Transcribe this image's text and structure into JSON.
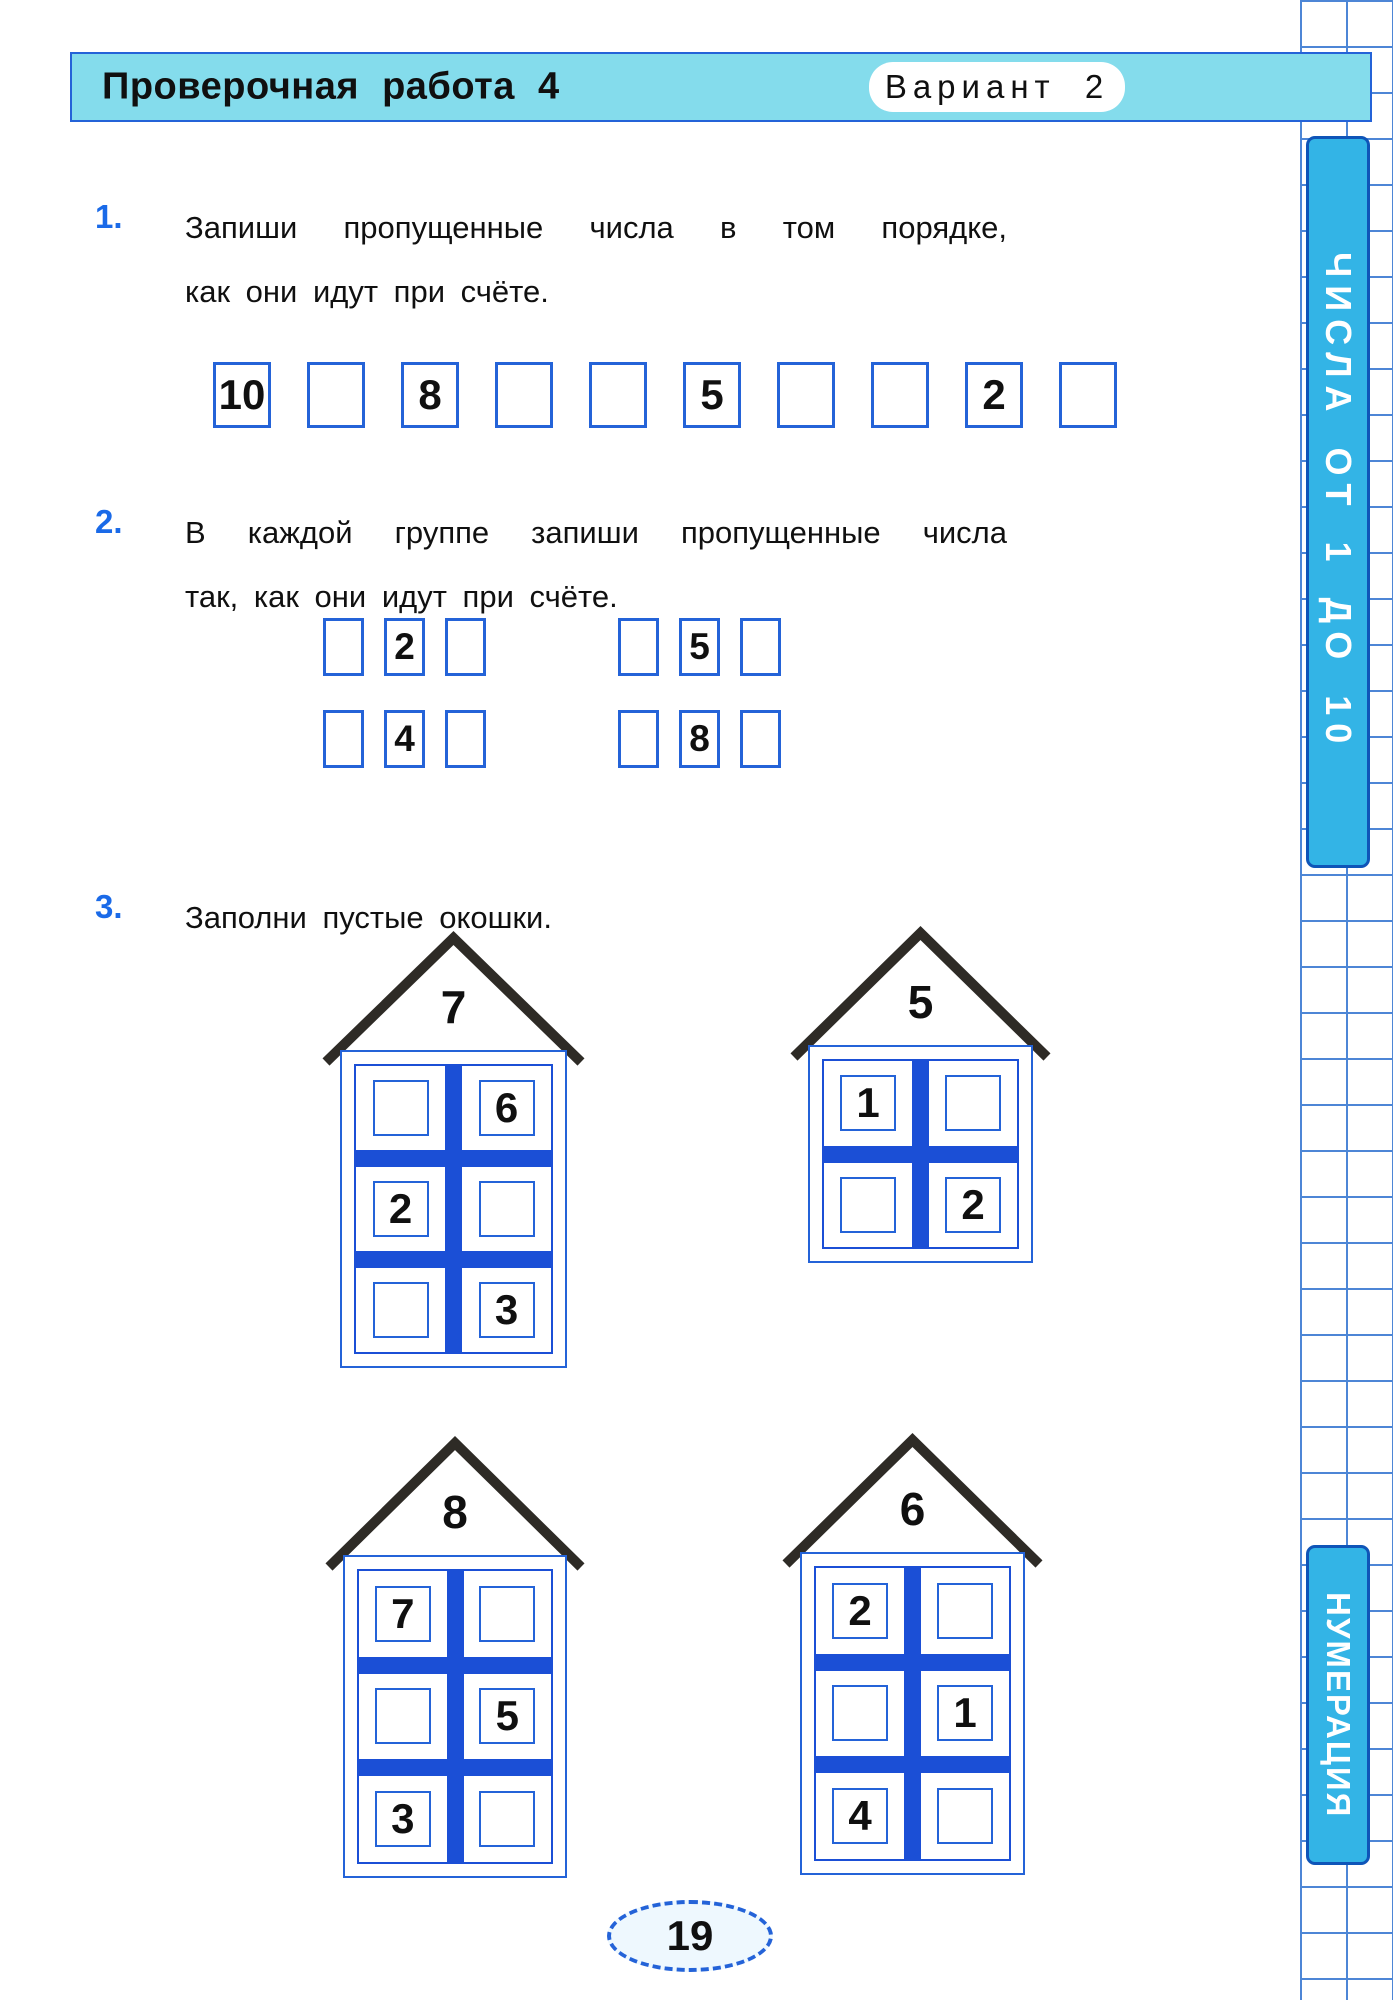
{
  "header": {
    "title": "Проверочная работа 4",
    "variant": "Вариант 2"
  },
  "sidebar": {
    "top_label": "ЧИСЛА ОТ 1 ДО 10",
    "bottom_label": "НУМЕРАЦИЯ"
  },
  "tasks": [
    {
      "number": "1.",
      "lines": [
        "Запиши пропущенные числа в том порядке,",
        "как они идут при счёте."
      ]
    },
    {
      "number": "2.",
      "lines": [
        "В каждой группе запиши пропущенные числа",
        "так, как они идут при счёте."
      ]
    },
    {
      "number": "3.",
      "lines": [
        "Заполни пустые окошки."
      ]
    }
  ],
  "task1_boxes": [
    "10",
    "",
    "8",
    "",
    "",
    "5",
    "",
    "",
    "2",
    ""
  ],
  "task2_groups": [
    {
      "rows": [
        [
          "",
          "2",
          ""
        ],
        [
          "",
          "4",
          ""
        ]
      ]
    },
    {
      "rows": [
        [
          "",
          "5",
          ""
        ],
        [
          "",
          "8",
          ""
        ]
      ]
    }
  ],
  "houses": [
    {
      "roof": "7",
      "floors": [
        [
          "",
          "6"
        ],
        [
          "2",
          ""
        ],
        [
          "",
          "3"
        ]
      ]
    },
    {
      "roof": "5",
      "floors": [
        [
          "1",
          ""
        ],
        [
          "",
          "2"
        ]
      ]
    },
    {
      "roof": "8",
      "floors": [
        [
          "7",
          ""
        ],
        [
          "",
          "5"
        ],
        [
          "3",
          ""
        ]
      ]
    },
    {
      "roof": "6",
      "floors": [
        [
          "2",
          ""
        ],
        [
          "",
          "1"
        ],
        [
          "4",
          ""
        ]
      ]
    }
  ],
  "page_number": "19",
  "colors": {
    "accent_blue": "#2463d8",
    "thick_blue": "#1b4fd6",
    "header_cyan": "#84dcec",
    "strip_cyan": "#33b4e6",
    "strip_border": "#0f55b8",
    "grid_line": "#4d86d6",
    "task_number_blue": "#1a6ae8",
    "roof_dark": "#2e2b26",
    "text_black": "#101010"
  }
}
